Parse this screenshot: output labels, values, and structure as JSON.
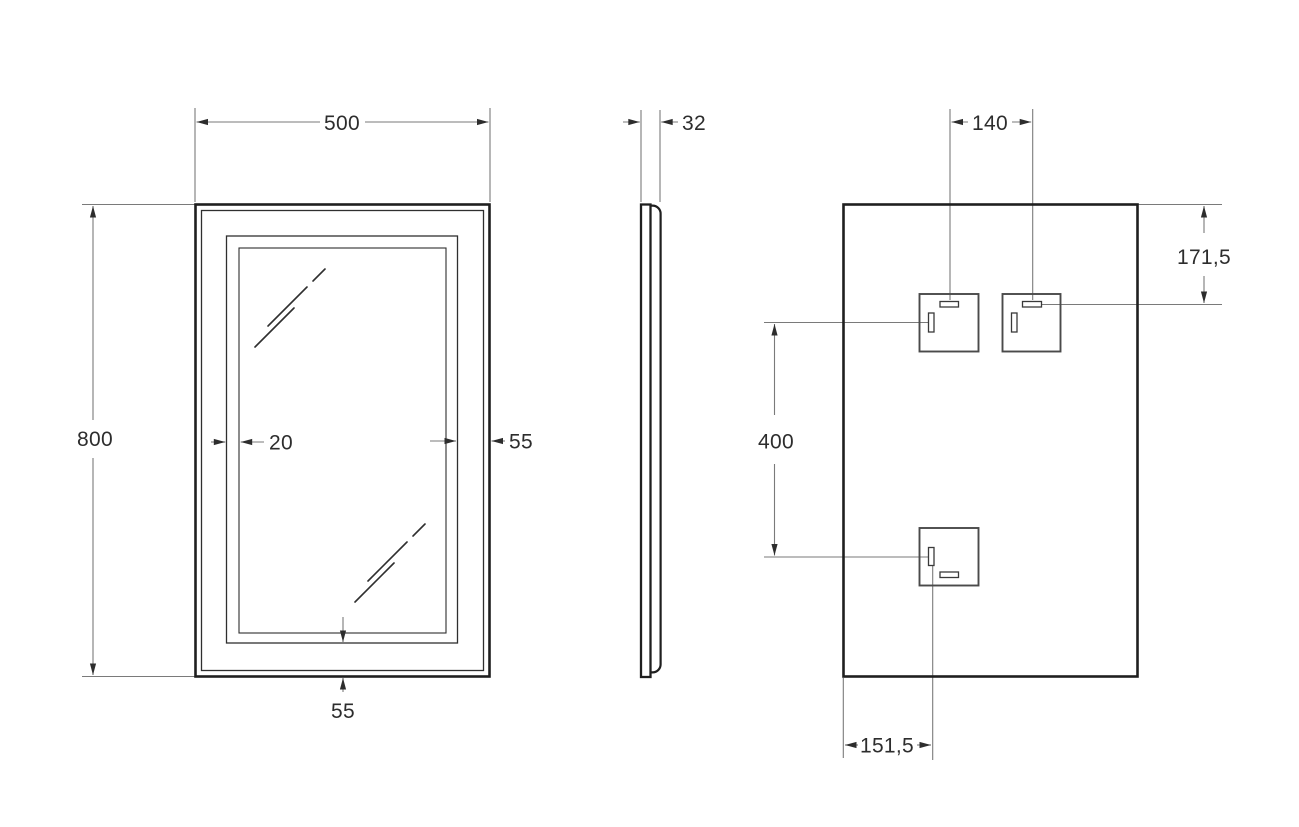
{
  "drawing": {
    "title": "mirror-technical-drawing",
    "front_view": {
      "width": "500",
      "height": "800",
      "led_inset": "20",
      "right_margin": "55",
      "bottom_margin": "55"
    },
    "side_view": {
      "depth": "32"
    },
    "back_view": {
      "bracket_spacing": "140",
      "top_offset": "171,5",
      "bracket_vertical_span": "400",
      "bottom_left_offset": "151,5"
    },
    "colors": {
      "outline": "#1f1f1f",
      "dimension_line": "#7a7a7a",
      "label_text": "#2d2d2d",
      "background": "#ffffff"
    }
  }
}
